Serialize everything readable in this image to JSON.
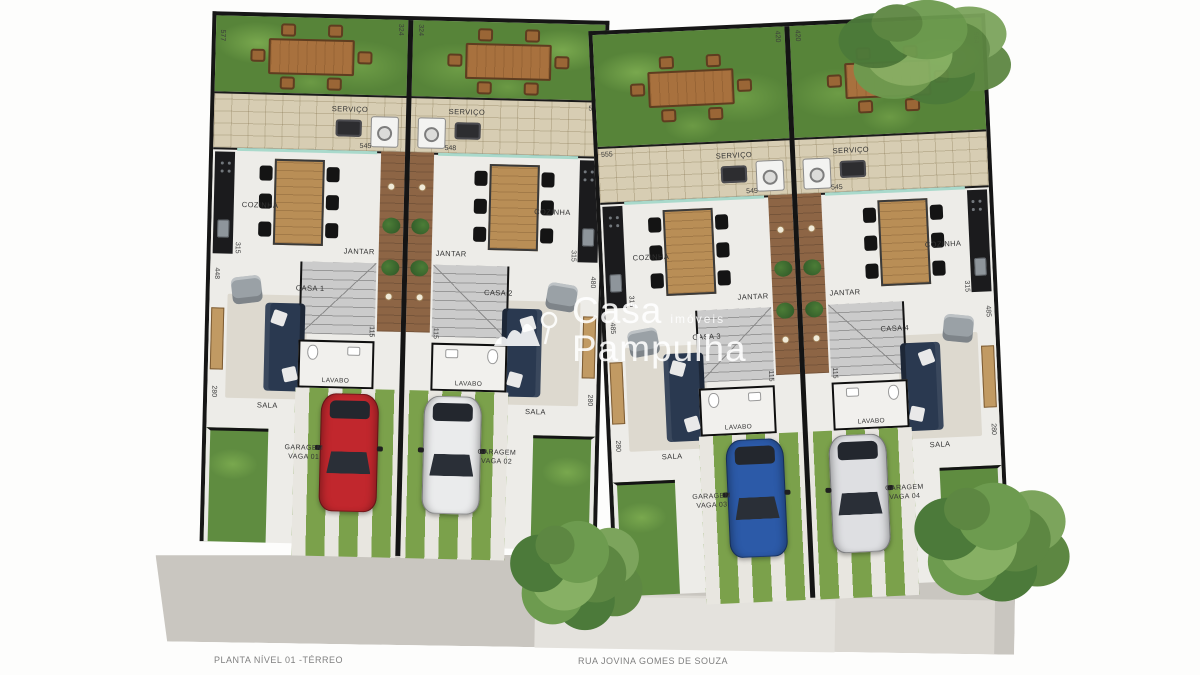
{
  "watermark": {
    "title_1": "Casa",
    "title_2": "Pampulha",
    "subtitle": "imóveis"
  },
  "footer": {
    "plan_label": "PLANTA NÍVEL 01 -TÉRREO",
    "street_label": "RUA JOVINA GOMES DE SOUZA"
  },
  "colors": {
    "wall": "#161616",
    "grass": "#578439",
    "pavers": "#d7cdb3",
    "deck_wood": "#8d6545",
    "sofa_navy": "#2a3950",
    "car_red": "#c1272d",
    "car_white": "#eaebec",
    "car_blue": "#2c5aa8",
    "car_silver": "#dedfe2"
  },
  "units": [
    {
      "name": "CASA 1",
      "servico": "SERVIÇO",
      "cozinha": "COZINHA",
      "jantar": "JANTAR",
      "lavabo": "LAVABO",
      "sala": "SALA",
      "garagem": "GARAGEM",
      "vaga": "VAGA 01",
      "car_color": "#c1272d",
      "dims": {
        "garden_side": "577",
        "garden_top": "324",
        "service": "545",
        "edge_top": "",
        "kitchen_wall": "315",
        "sala_wall": "448",
        "lavabo_w": "115",
        "lavabo_d": "150",
        "hall": "380",
        "bottom": "280"
      }
    },
    {
      "name": "CASA 2",
      "servico": "SERVIÇO",
      "cozinha": "COZINHA",
      "jantar": "JANTAR",
      "lavabo": "LAVABO",
      "sala": "SALA",
      "garagem": "GARAGEM",
      "vaga": "VAGA 02",
      "car_color": "#eaebec",
      "dims": {
        "garden_side": "",
        "garden_top": "324",
        "service": "548",
        "edge_top": "555",
        "kitchen_wall": "315",
        "sala_wall": "480",
        "lavabo_w": "115",
        "lavabo_d": "150",
        "hall": "380",
        "bottom": "280"
      }
    },
    {
      "name": "CASA 3",
      "servico": "SERVIÇO",
      "cozinha": "COZINHA",
      "jantar": "JANTAR",
      "lavabo": "LAVABO",
      "sala": "SALA",
      "garagem": "GARAGEM",
      "vaga": "VAGA 03",
      "car_color": "#2c5aa8",
      "dims": {
        "garden_side": "",
        "garden_top": "420",
        "service": "545",
        "edge_top": "555",
        "kitchen_wall": "315",
        "sala_wall": "485",
        "lavabo_w": "115",
        "lavabo_d": "150",
        "hall": "383",
        "bottom": "280"
      }
    },
    {
      "name": "CASA 4",
      "servico": "SERVIÇO",
      "cozinha": "COZINHA",
      "jantar": "JANTAR",
      "lavabo": "LAVABO",
      "sala": "SALA",
      "garagem": "GARAGEM",
      "vaga": "VAGA 04",
      "car_color": "#dedfe2",
      "dims": {
        "garden_side": "564",
        "garden_top": "420",
        "service": "545",
        "edge_top": "",
        "kitchen_wall": "315",
        "sala_wall": "485",
        "lavabo_w": "115",
        "lavabo_d": "150",
        "hall": "383",
        "bottom": "280"
      }
    }
  ]
}
